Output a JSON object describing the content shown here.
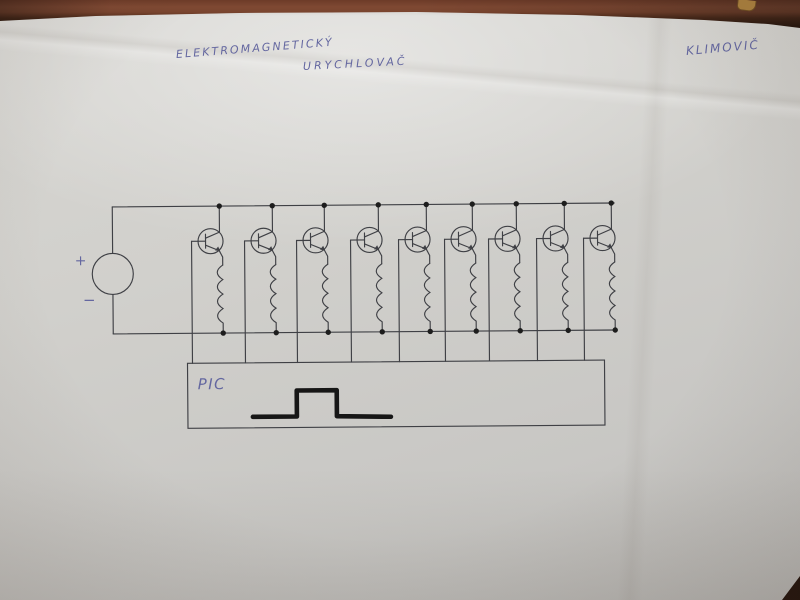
{
  "colors": {
    "desk": "#6d3b28",
    "paper": "#d1d0cc",
    "ink": "#6467a0",
    "pencil": "#3f4045",
    "dot": "#1d1d1d",
    "pulse": "#161616"
  },
  "annotations": {
    "title_line1": "ELEKTROMAGNETICKÝ",
    "title_line2": "URYCHLOVAČ",
    "author": "KLIMOVIČ"
  },
  "labels": {
    "source_plus": "+",
    "source_minus": "−",
    "controller": "PIC"
  },
  "diagram": {
    "stage_count": 9,
    "stage_top_x": [
      220,
      273,
      325,
      379,
      427,
      473,
      517,
      565,
      612
    ],
    "rails": {
      "top_y": 205,
      "bottom_y": 332,
      "left_x": 113,
      "right_x": 615
    },
    "source": {
      "cx": 113,
      "cy": 272,
      "r": 20.5
    },
    "transistor": {
      "cy": 240,
      "r": 12.5
    },
    "coil": {
      "top_y": 264,
      "bumps": 4,
      "bump_h": 14.5
    },
    "controller_box": {
      "x": 187,
      "y": 362,
      "w": 417,
      "h": 65
    },
    "pulse_points": [
      [
        252,
        416
      ],
      [
        296,
        416
      ],
      [
        296,
        390
      ],
      [
        336,
        390
      ],
      [
        336,
        416
      ],
      [
        390,
        417
      ]
    ],
    "tilt_deg": -0.45
  }
}
